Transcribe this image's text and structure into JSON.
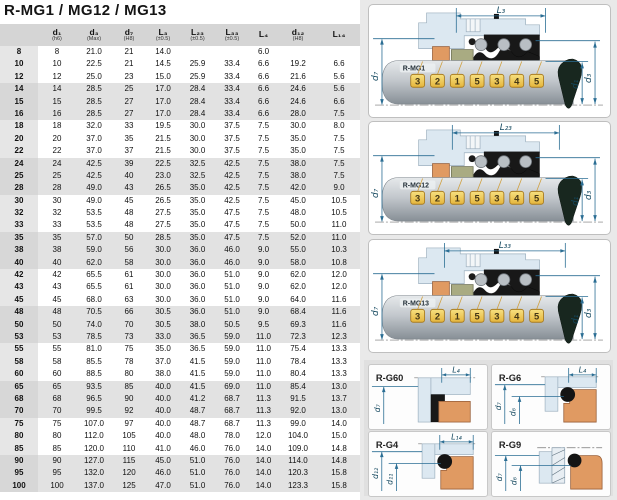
{
  "title": "R-MG1 / MG12 / MG13",
  "table": {
    "headers": [
      {
        "label": "",
        "sub": ""
      },
      {
        "label": "d₁",
        "sub": "(h6)"
      },
      {
        "label": "d₃",
        "sub": "(Max)"
      },
      {
        "label": "d₇",
        "sub": "(H8)"
      },
      {
        "label": "L₃",
        "sub": "(±0.5)"
      },
      {
        "label": "L₂₃",
        "sub": "(±0.5)"
      },
      {
        "label": "L₃₃",
        "sub": "(±0.5)"
      },
      {
        "label": "L₄",
        "sub": ""
      },
      {
        "label": "d₁₂",
        "sub": "(H8)"
      },
      {
        "label": "L₁₄",
        "sub": ""
      }
    ],
    "rows": [
      [
        "8",
        "8",
        "21.0",
        "21",
        "14.0",
        "",
        "",
        "6.0",
        "",
        ""
      ],
      [
        "10",
        "10",
        "22.5",
        "21",
        "14.5",
        "25.9",
        "33.4",
        "6.6",
        "19.2",
        "6.6"
      ],
      [
        "12",
        "12",
        "25.0",
        "23",
        "15.0",
        "25.9",
        "33.4",
        "6.6",
        "21.6",
        "5.6"
      ],
      [
        "14",
        "14",
        "28.5",
        "25",
        "17.0",
        "28.4",
        "33.4",
        "6.6",
        "24.6",
        "5.6"
      ],
      [
        "15",
        "15",
        "28.5",
        "27",
        "17.0",
        "28.4",
        "33.4",
        "6.6",
        "24.6",
        "6.6"
      ],
      [
        "16",
        "16",
        "28.5",
        "27",
        "17.0",
        "28.4",
        "33.4",
        "6.6",
        "28.0",
        "7.5"
      ],
      [
        "18",
        "18",
        "32.0",
        "33",
        "19.5",
        "30.0",
        "37.5",
        "7.5",
        "30.0",
        "8.0"
      ],
      [
        "20",
        "20",
        "37.0",
        "35",
        "21.5",
        "30.0",
        "37.5",
        "7.5",
        "35.0",
        "7.5"
      ],
      [
        "22",
        "22",
        "37.0",
        "37",
        "21.5",
        "30.0",
        "37.5",
        "7.5",
        "35.0",
        "7.5"
      ],
      [
        "24",
        "24",
        "42.5",
        "39",
        "22.5",
        "32.5",
        "42.5",
        "7.5",
        "38.0",
        "7.5"
      ],
      [
        "25",
        "25",
        "42.5",
        "40",
        "23.0",
        "32.5",
        "42.5",
        "7.5",
        "38.0",
        "7.5"
      ],
      [
        "28",
        "28",
        "49.0",
        "43",
        "26.5",
        "35.0",
        "42.5",
        "7.5",
        "42.0",
        "9.0"
      ],
      [
        "30",
        "30",
        "49.0",
        "45",
        "26.5",
        "35.0",
        "42.5",
        "7.5",
        "45.0",
        "10.5"
      ],
      [
        "32",
        "32",
        "53.5",
        "48",
        "27.5",
        "35.0",
        "47.5",
        "7.5",
        "48.0",
        "10.5"
      ],
      [
        "33",
        "33",
        "53.5",
        "48",
        "27.5",
        "35.0",
        "47.5",
        "7.5",
        "50.0",
        "11.0"
      ],
      [
        "35",
        "35",
        "57.0",
        "50",
        "28.5",
        "35.0",
        "47.5",
        "7.5",
        "52.0",
        "11.0"
      ],
      [
        "38",
        "38",
        "59.0",
        "56",
        "30.0",
        "36.0",
        "46.0",
        "9.0",
        "55.0",
        "10.3"
      ],
      [
        "40",
        "40",
        "62.0",
        "58",
        "30.0",
        "36.0",
        "46.0",
        "9.0",
        "58.0",
        "10.8"
      ],
      [
        "42",
        "42",
        "65.5",
        "61",
        "30.0",
        "36.0",
        "51.0",
        "9.0",
        "62.0",
        "12.0"
      ],
      [
        "43",
        "43",
        "65.5",
        "61",
        "30.0",
        "36.0",
        "51.0",
        "9.0",
        "62.0",
        "12.0"
      ],
      [
        "45",
        "45",
        "68.0",
        "63",
        "30.0",
        "36.0",
        "51.0",
        "9.0",
        "64.0",
        "11.6"
      ],
      [
        "48",
        "48",
        "70.5",
        "66",
        "30.5",
        "36.0",
        "51.0",
        "9.0",
        "68.4",
        "11.6"
      ],
      [
        "50",
        "50",
        "74.0",
        "70",
        "30.5",
        "38.0",
        "50.5",
        "9.5",
        "69.3",
        "11.6"
      ],
      [
        "53",
        "53",
        "78.5",
        "73",
        "33.0",
        "36.5",
        "59.0",
        "11.0",
        "72.3",
        "12.3"
      ],
      [
        "55",
        "55",
        "81.0",
        "75",
        "35.0",
        "36.5",
        "59.0",
        "11.0",
        "75.4",
        "13.3"
      ],
      [
        "58",
        "58",
        "85.5",
        "78",
        "37.0",
        "41.5",
        "59.0",
        "11.0",
        "78.4",
        "13.3"
      ],
      [
        "60",
        "60",
        "88.5",
        "80",
        "38.0",
        "41.5",
        "59.0",
        "11.0",
        "80.4",
        "13.3"
      ],
      [
        "65",
        "65",
        "93.5",
        "85",
        "40.0",
        "41.5",
        "69.0",
        "11.0",
        "85.4",
        "13.0"
      ],
      [
        "68",
        "68",
        "96.5",
        "90",
        "40.0",
        "41.2",
        "68.7",
        "11.3",
        "91.5",
        "13.7"
      ],
      [
        "70",
        "70",
        "99.5",
        "92",
        "40.0",
        "48.7",
        "68.7",
        "11.3",
        "92.0",
        "13.0"
      ],
      [
        "75",
        "75",
        "107.0",
        "97",
        "40.0",
        "48.7",
        "68.7",
        "11.3",
        "99.0",
        "14.0"
      ],
      [
        "80",
        "80",
        "112.0",
        "105",
        "40.0",
        "48.0",
        "78.0",
        "12.0",
        "104.0",
        "15.0"
      ],
      [
        "85",
        "85",
        "120.0",
        "110",
        "41.0",
        "46.0",
        "76.0",
        "14.0",
        "109.0",
        "14.8"
      ],
      [
        "90",
        "90",
        "127.0",
        "115",
        "45.0",
        "51.0",
        "76.0",
        "14.0",
        "114.0",
        "14.8"
      ],
      [
        "95",
        "95",
        "132.0",
        "120",
        "46.0",
        "51.0",
        "76.0",
        "14.0",
        "120.3",
        "15.8"
      ],
      [
        "100",
        "100",
        "137.0",
        "125",
        "47.0",
        "51.0",
        "76.0",
        "14.0",
        "123.3",
        "15.8"
      ]
    ]
  },
  "diagrams": {
    "tag_numbers": [
      "3",
      "2",
      "1",
      "5",
      "3",
      "4",
      "5"
    ],
    "mg1": {
      "name": "R-MG1",
      "dim_top": "L₃",
      "dim_left": "d₇",
      "dim_r1": "d₁",
      "dim_r2": "d₃"
    },
    "mg12": {
      "name": "R-MG12",
      "dim_top": "L₂₃",
      "dim_left": "d₇",
      "dim_r1": "d₁",
      "dim_r2": "d₃"
    },
    "mg13": {
      "name": "R-MG13",
      "dim_top": "L₃₃",
      "dim_left": "d₇",
      "dim_r1": "d₁",
      "dim_r2": "d₃"
    }
  },
  "details": {
    "g60": {
      "name": "R-G60",
      "dim_top": "L₄",
      "dim_a": "d₇",
      "dim_b": ""
    },
    "g6": {
      "name": "R-G6",
      "dim_top": "L₄",
      "dim_a": "d₇",
      "dim_b": "d₆"
    },
    "g4": {
      "name": "R-G4",
      "dim_top": "L₁₄",
      "dim_a": "d₁₂",
      "dim_b": "d₁₁"
    },
    "g9": {
      "name": "R-G9",
      "dim_top": "",
      "dim_a": "d₇",
      "dim_b": "d₆"
    }
  },
  "colors": {
    "accent_dim": "#2b6e94",
    "seat_orange": "#e09a62",
    "face_olive": "#a9ab82",
    "tag_yellow": "#e9b93e",
    "housing_blue": "#dce8f1",
    "band_gray": "#e2e2e2",
    "header_gray": "#d5d5d5"
  }
}
